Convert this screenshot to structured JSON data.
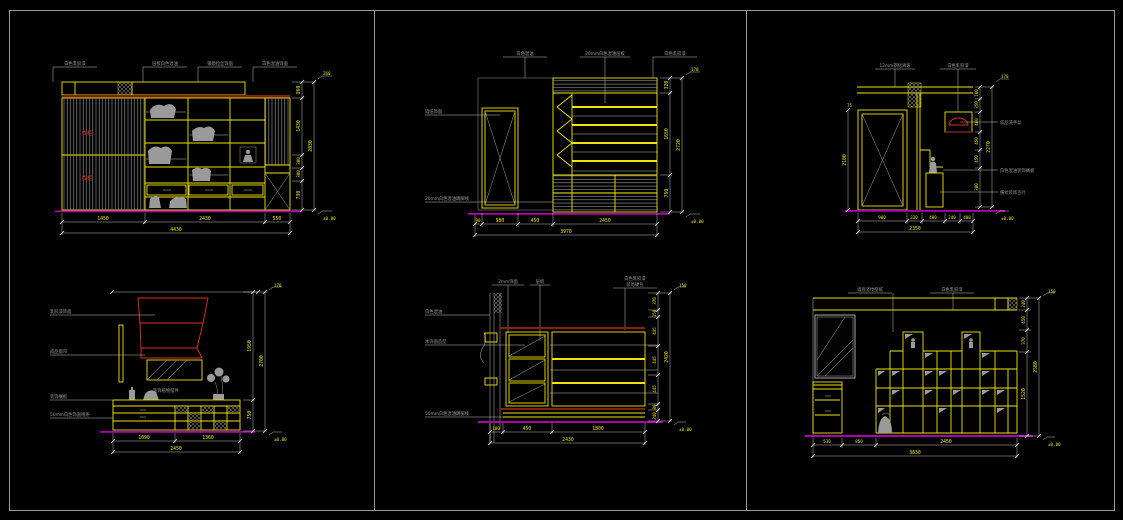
{
  "sheet": {
    "type": "interior-elevation-cad-sheet",
    "background": "#000000",
    "frame_color": "#9a9a9a",
    "panel_count": 6
  },
  "colors": {
    "line": "#f0e400",
    "dim_text": "#efe400",
    "dim_line": "#d8d8d8",
    "label": "#9b9b9b",
    "hatch": "#8a8a8a",
    "maroon": "#7e2211",
    "baseline": "#aa00aa",
    "red": "#e03020"
  },
  "drawings": {
    "d1": {
      "title": "wardrobe-elevation",
      "top_labels": [
        "白色乳胶漆",
        "层板白色混油",
        "银镜拉丝饰面",
        "白色混油饰面"
      ],
      "red_marks": [
        "衣柜",
        "衣柜"
      ],
      "bottom_dims": [
        "1450",
        "2430",
        "550"
      ],
      "bottom_total": "4430",
      "right_dims": [
        "360",
        "1430",
        "300",
        "300",
        "730"
      ],
      "right_total": "2830",
      "datum_top": "260",
      "datum_bottom": "±0.00"
    },
    "d2": {
      "title": "cabinet-elevation",
      "top_labels": [
        "白色混油",
        "20mm白色混油层板",
        "白色乳胶漆"
      ],
      "left_labels": [
        "墙纸饰面",
        "20mm白色混油踢脚线"
      ],
      "bottom_dims": [
        "90",
        "980",
        "450",
        "2450"
      ],
      "bottom_total": "3970",
      "right_dims": [
        "320",
        "1650",
        "750"
      ],
      "right_total": "2720",
      "datum_top": "170",
      "datum_bottom": "±0.00"
    },
    "d3": {
      "title": "door-niche-elevation",
      "top_labels": [
        "12mm钢化清玻",
        "白色乳胶漆"
      ],
      "right_labels": [
        "成品洗手盆",
        "白色混油装饰搁板",
        "横纹装饰百叶"
      ],
      "left_dim": "2100",
      "left_top_dim": "75",
      "right_dims": [
        "180",
        "350",
        "460",
        "450",
        "450",
        "380"
      ],
      "right_total": "2270",
      "bottom_dims": [
        "900",
        "330",
        "480",
        "240",
        "400"
      ],
      "bottom_total": "2350",
      "datum_top": "170",
      "datum_bottom": "±0.00"
    },
    "d4": {
      "title": "window-seat-elevation",
      "left_labels": [
        "乳胶漆饰面",
        "成品窗帘",
        "装饰搁板",
        "50mm白色饰面线条"
      ],
      "mid_label": "装饰植物摆件",
      "bottom_dims": [
        "1090",
        "1360"
      ],
      "bottom_total": "2450",
      "right_dims": [
        "1950",
        "750"
      ],
      "right_total": "2700",
      "datum_top": "170",
      "datum_bottom": "±0.00"
    },
    "d5": {
      "title": "display-cabinet-elevation",
      "top_labels": [
        "2mm饰面",
        "层板",
        "白色乳胶漆",
        "装饰硬包"
      ],
      "left_labels": [
        "白色混油",
        "木饰面造型",
        "50mm白色混油踢脚线"
      ],
      "right_dims": [
        "370",
        "150",
        "445",
        "445",
        "445",
        "80",
        "240"
      ],
      "right_total": "2420",
      "bottom_dims": [
        "180",
        "450",
        "1800"
      ],
      "bottom_total": "2430",
      "datum_top": "150",
      "datum_bottom": "±0.00"
    },
    "d6": {
      "title": "bookshelf-elevation",
      "top_labels": [
        "墙面竖纹壁纸",
        "白色乳胶漆"
      ],
      "bottom_dims": [
        "530",
        "850",
        "2450"
      ],
      "bottom_total": "3830",
      "right_dims": [
        "240",
        "450",
        "370",
        "1520"
      ],
      "right_total": "2580",
      "datum_top": "150",
      "datum_bottom": "±0.00"
    }
  }
}
